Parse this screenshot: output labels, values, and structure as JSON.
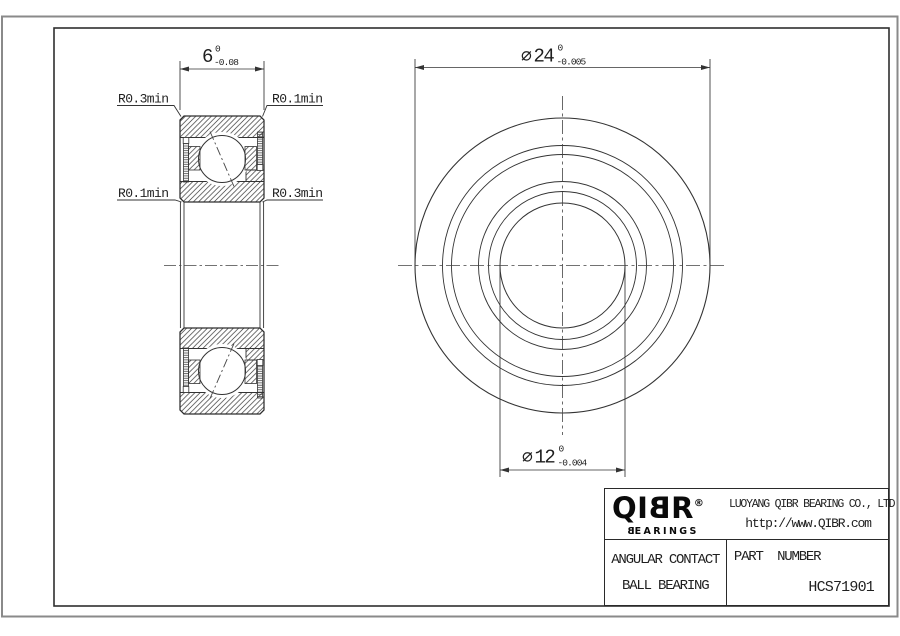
{
  "drawing": {
    "section_view": {
      "width_dim": {
        "value": "6",
        "tol_upper": "0",
        "tol_lower": "-0.08"
      },
      "radius_labels": {
        "top_left": "R0.3min",
        "top_right": "R0.1min",
        "bottom_left": "R0.1min",
        "bottom_right": "R0.3min"
      }
    },
    "front_view": {
      "outer_dim": {
        "symbol": "⌀",
        "value": "24",
        "tol_upper": "0",
        "tol_lower": "-0.005"
      },
      "bore_dim": {
        "symbol": "⌀",
        "value": "12",
        "tol_upper": "0",
        "tol_lower": "-0.004"
      }
    }
  },
  "title_block": {
    "logo": {
      "part1": "QI",
      "mirrored_letter": "B",
      "part2": "R",
      "registered": "®",
      "tagline_first": "B",
      "tagline_rest": "EARINGS"
    },
    "company_name": "LUOYANG QIBR BEARING CO., LTD",
    "website": "http://www.QIBR.com",
    "product_type_line1": "ANGULAR CONTACT",
    "product_type_line2": "BALL BEARING",
    "part_number_label": "PART  NUMBER",
    "part_number": "HCS71901"
  },
  "colors": {
    "line": "#333333",
    "text": "#1f1f1f",
    "frame_outer": "#8a8a8a"
  }
}
